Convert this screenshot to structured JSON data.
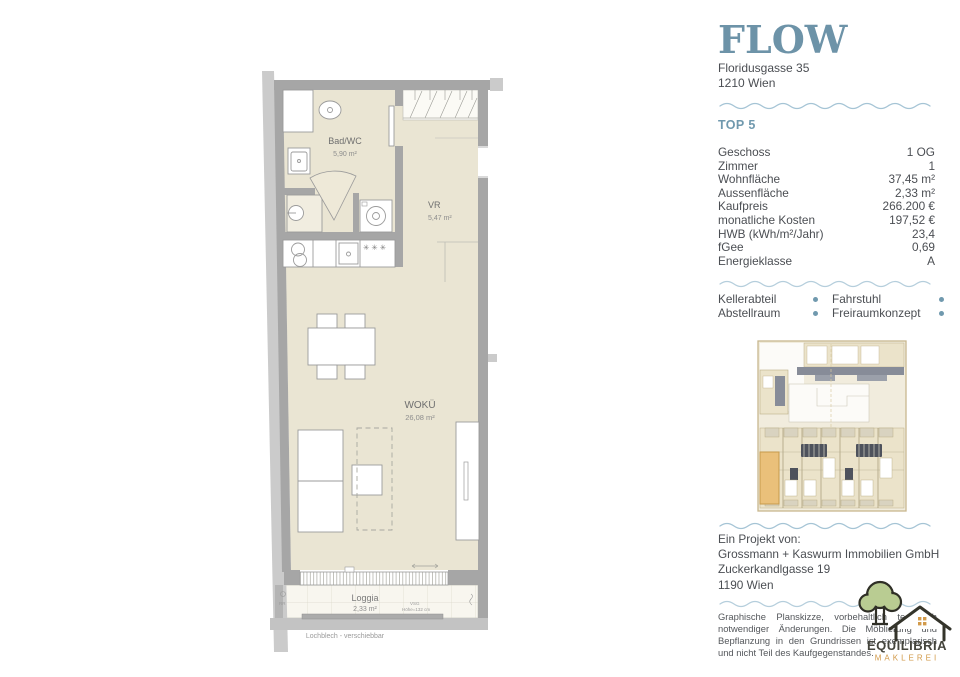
{
  "branding": {
    "logo_text": "FLOW",
    "address_line1": "Floridusgasse 35",
    "address_line2": "1210 Wien"
  },
  "unit": {
    "title": "TOP 5"
  },
  "details": {
    "rows": [
      {
        "label": "Geschoss",
        "value": "1 OG"
      },
      {
        "label": "Zimmer",
        "value": "1"
      },
      {
        "label": "Wohnfläche",
        "value": "37,45 m²"
      },
      {
        "label": "Aussenfläche",
        "value": "2,33 m²"
      },
      {
        "label": "Kaufpreis",
        "value": "266.200 €"
      },
      {
        "label": "monatliche Kosten",
        "value": "197,52 €"
      },
      {
        "label": "HWB (kWh/m²/Jahr)",
        "value": "23,4"
      },
      {
        "label": "fGee",
        "value": "0,69"
      },
      {
        "label": "Energieklasse",
        "value": "A"
      }
    ]
  },
  "amenities": {
    "items": [
      "Kellerabteil",
      "Fahrstuhl",
      "Abstellraum",
      "Freiraumkonzept"
    ]
  },
  "floorplan": {
    "rooms": [
      {
        "name": "Bad/WC",
        "area": "5,90 m²"
      },
      {
        "name": "VR",
        "area": "5,47 m²"
      },
      {
        "name": "WOKÜ",
        "area": "26,08 m²"
      },
      {
        "name": "Loggia",
        "area": "2,33 m²"
      }
    ],
    "annotations": {
      "stars": "✳ ✳ ✳",
      "glass": "VSG",
      "glass_height": "Höhe=132 cm",
      "rain": "RR",
      "caption": "Lochblech - verschiebbar"
    }
  },
  "project": {
    "heading": "Ein Projekt von:",
    "company": "Grossmann + Kaswurm Immobilien GmbH",
    "street": "Zuckerkandlgasse 19",
    "city": "1190 Wien"
  },
  "disclaimer": {
    "text": "Graphische Planskizze, vorbehaltlich technisch notwendiger Änderungen. Die Möblierung und Bepflanzung in den Grundrissen ist exemplarisch und nicht Teil des Kaufgegenstandes."
  },
  "agency": {
    "name": "EQUILIBRIA",
    "subtitle": "MAKLEREI"
  },
  "colors": {
    "accent_blue": "#7099ae",
    "logo_blue": "#6d93a8",
    "wave_blue": "#a5c4d5",
    "floor_cream": "#eae5d3",
    "wall_gray": "#a6a6a6",
    "highlight_orange": "#eac07a",
    "tree_green": "#b9cc92",
    "maklerei_orange": "#d29a4a"
  }
}
